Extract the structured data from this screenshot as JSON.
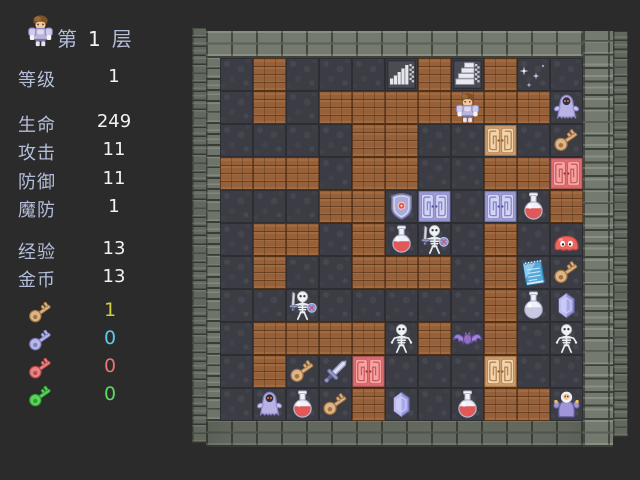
{
  "sidebar": {
    "floor": {
      "prefix": "第",
      "number": "1",
      "suffix": "层"
    },
    "stats": [
      {
        "id": "level",
        "label": "等级",
        "value": "1"
      },
      {
        "id": "hp",
        "label": "生命",
        "value": "249"
      },
      {
        "id": "attack",
        "label": "攻击",
        "value": "11"
      },
      {
        "id": "defense",
        "label": "防御",
        "value": "11"
      },
      {
        "id": "magic-defense",
        "label": "魔防",
        "value": "1"
      },
      {
        "id": "experience",
        "label": "经验",
        "value": "13"
      },
      {
        "id": "gold",
        "label": "金币",
        "value": "13"
      }
    ],
    "keys": [
      {
        "id": "yellow-key",
        "count": "1",
        "icon_fill": "#dcb58b",
        "icon_outline": "#a4743f",
        "count_color": "#cfcf3f"
      },
      {
        "id": "blue-key",
        "count": "0",
        "icon_fill": "#b7b7e8",
        "icon_outline": "#7f7fbe",
        "count_color": "#5cc9e8"
      },
      {
        "id": "red-key",
        "count": "0",
        "icon_fill": "#ea8585",
        "icon_outline": "#bf4c4c",
        "count_color": "#e87373"
      },
      {
        "id": "green-key",
        "count": "0",
        "icon_fill": "#5ed45e",
        "icon_outline": "#2f9f2f",
        "count_color": "#5dd95d"
      }
    ]
  },
  "map": {
    "rows": 11,
    "cols": 11,
    "legend": {
      ".": "stone-floor",
      "#": "dirt-wall"
    },
    "grid": [
      ".#....#.#..",
      ".#.#######.",
      "....##.....",
      "###.##..##.",
      "...##.....#",
      ".##.#...#..",
      ".#..###.#..",
      "........#..",
      ".####.#.#..",
      ".#......#..",
      "....#...##."
    ],
    "sprites": [
      {
        "row": 0,
        "col": 5,
        "type": "stairs-down"
      },
      {
        "row": 0,
        "col": 7,
        "type": "stairs-up"
      },
      {
        "row": 0,
        "col": 9,
        "type": "sparkle"
      },
      {
        "row": 1,
        "col": 7,
        "type": "hero"
      },
      {
        "row": 1,
        "col": 10,
        "type": "ghost"
      },
      {
        "row": 2,
        "col": 8,
        "type": "door-yellow"
      },
      {
        "row": 2,
        "col": 10,
        "type": "key-yellow"
      },
      {
        "row": 3,
        "col": 10,
        "type": "door-red"
      },
      {
        "row": 4,
        "col": 5,
        "type": "shield"
      },
      {
        "row": 4,
        "col": 6,
        "type": "door-blue"
      },
      {
        "row": 4,
        "col": 8,
        "type": "door-blue"
      },
      {
        "row": 4,
        "col": 9,
        "type": "potion-red"
      },
      {
        "row": 5,
        "col": 5,
        "type": "potion-red"
      },
      {
        "row": 5,
        "col": 6,
        "type": "skeleton-warrior"
      },
      {
        "row": 5,
        "col": 10,
        "type": "slime-red"
      },
      {
        "row": 6,
        "col": 9,
        "type": "notebook"
      },
      {
        "row": 6,
        "col": 10,
        "type": "key-yellow"
      },
      {
        "row": 7,
        "col": 2,
        "type": "skeleton-warrior"
      },
      {
        "row": 7,
        "col": 9,
        "type": "potion-silver"
      },
      {
        "row": 7,
        "col": 10,
        "type": "gem-blue"
      },
      {
        "row": 8,
        "col": 5,
        "type": "skeleton"
      },
      {
        "row": 8,
        "col": 7,
        "type": "bat"
      },
      {
        "row": 8,
        "col": 10,
        "type": "skeleton"
      },
      {
        "row": 9,
        "col": 2,
        "type": "key-yellow"
      },
      {
        "row": 9,
        "col": 3,
        "type": "sword"
      },
      {
        "row": 9,
        "col": 4,
        "type": "door-red"
      },
      {
        "row": 9,
        "col": 8,
        "type": "door-yellow"
      },
      {
        "row": 10,
        "col": 1,
        "type": "ghost"
      },
      {
        "row": 10,
        "col": 2,
        "type": "potion-red"
      },
      {
        "row": 10,
        "col": 3,
        "type": "key-yellow"
      },
      {
        "row": 10,
        "col": 5,
        "type": "gem-blue"
      },
      {
        "row": 10,
        "col": 7,
        "type": "potion-red"
      },
      {
        "row": 10,
        "col": 10,
        "type": "wizard"
      }
    ]
  },
  "colors": {
    "background": "#2b2b2b",
    "label_text": "#b4bdd9",
    "value_text": "#f2f2f2",
    "floor_tile": "#3c3c44",
    "dirt_tile": "#96613a",
    "brick": "#747a6e"
  }
}
